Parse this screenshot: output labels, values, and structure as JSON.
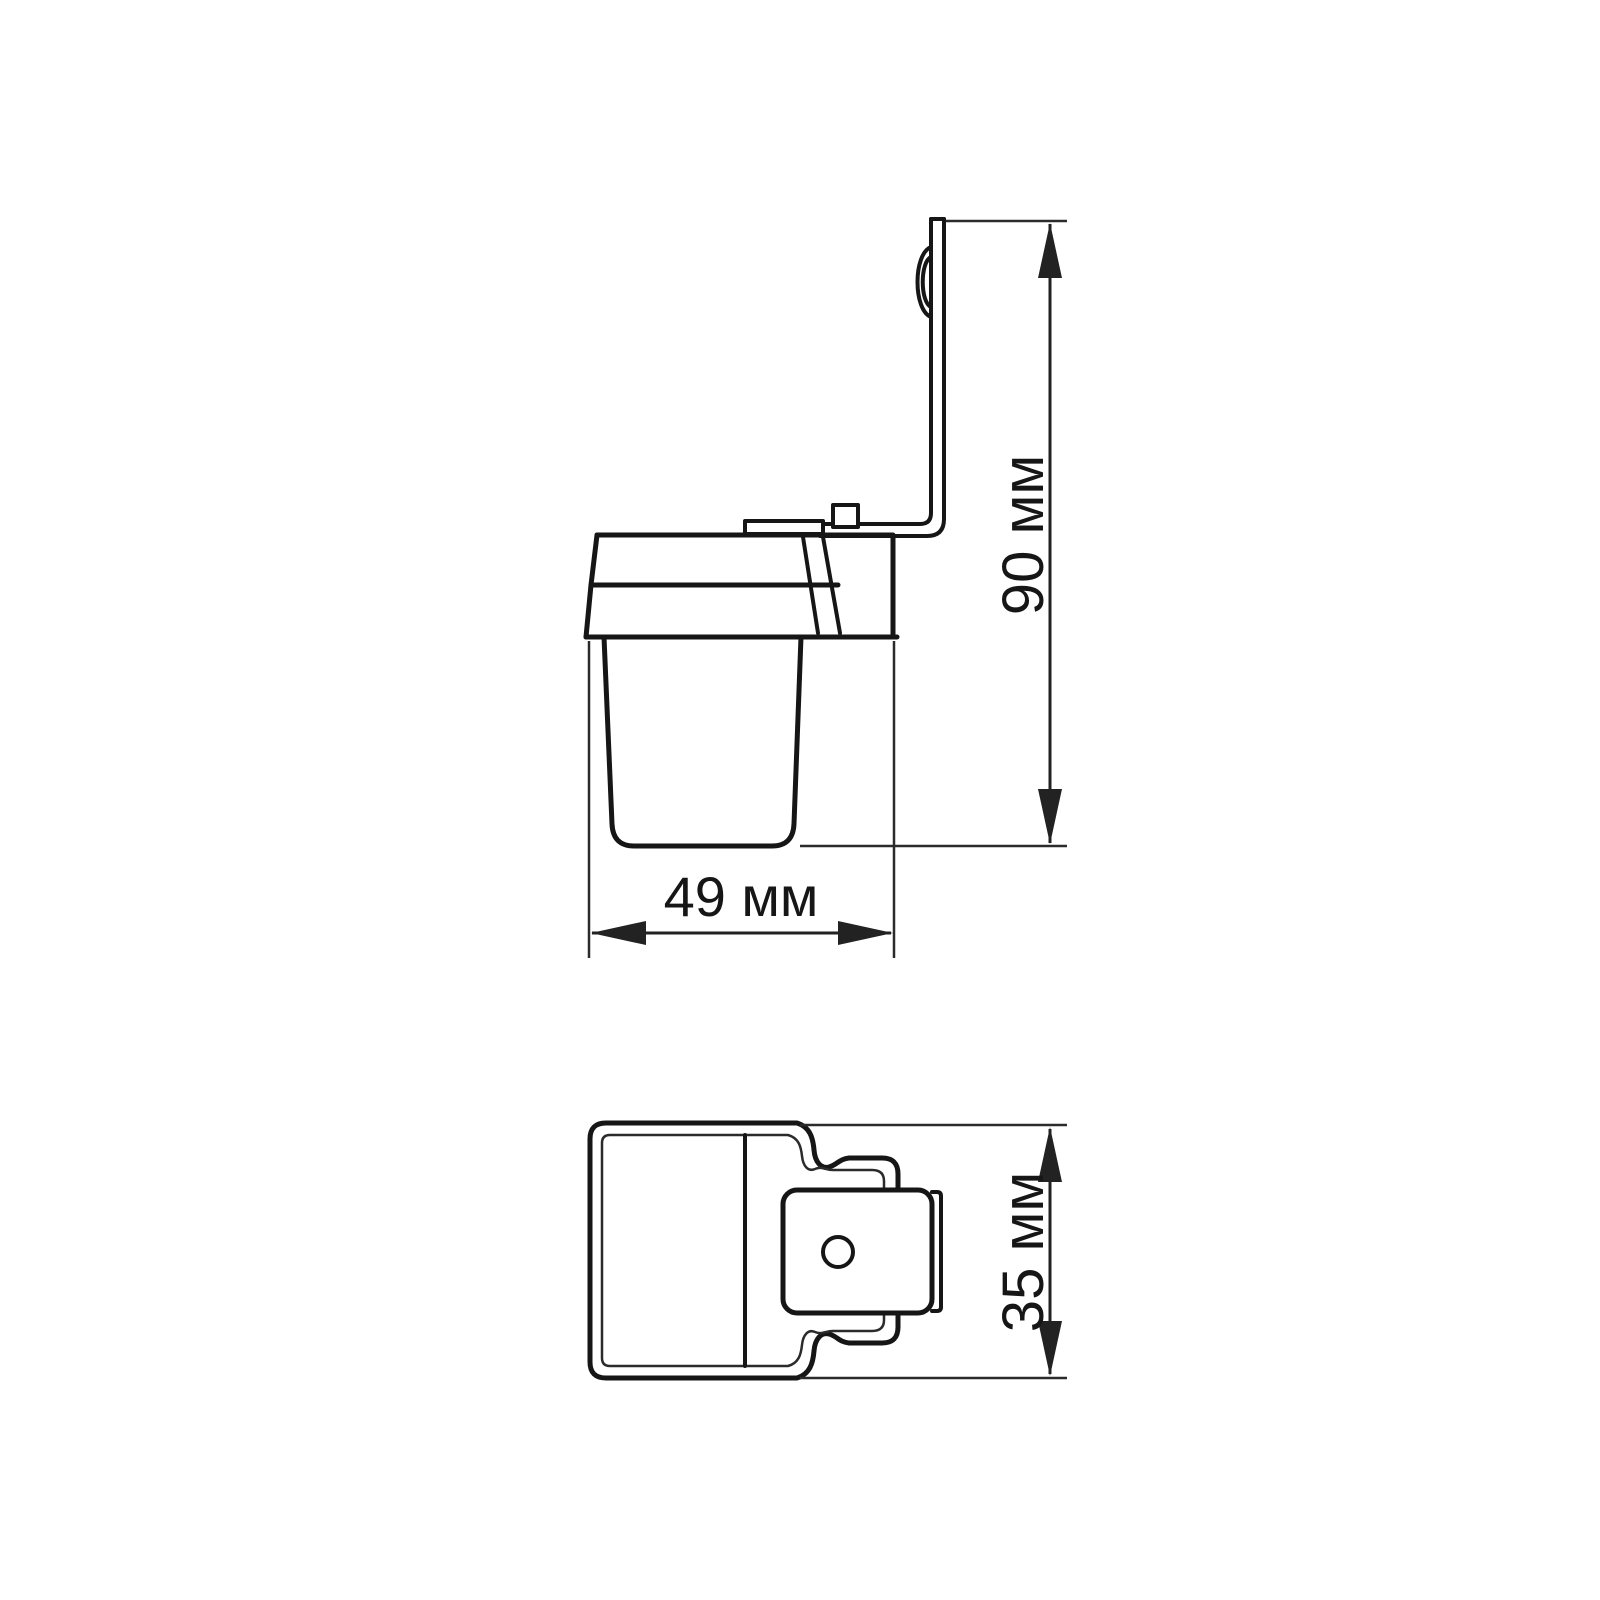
{
  "drawing": {
    "background": "#ffffff",
    "line_color": "#161616",
    "views": {
      "side": {
        "name": "side view with mounting bracket"
      },
      "top": {
        "name": "top view with bracket plate and hole"
      }
    },
    "dimensions": {
      "height": {
        "label": "90 мм",
        "value": 90,
        "unit": "мм",
        "orientation": "vertical"
      },
      "width": {
        "label": "49 мм",
        "value": 49,
        "unit": "мм",
        "orientation": "horizontal"
      },
      "depth": {
        "label": "35 мм",
        "value": 35,
        "unit": "мм",
        "orientation": "vertical"
      }
    }
  }
}
